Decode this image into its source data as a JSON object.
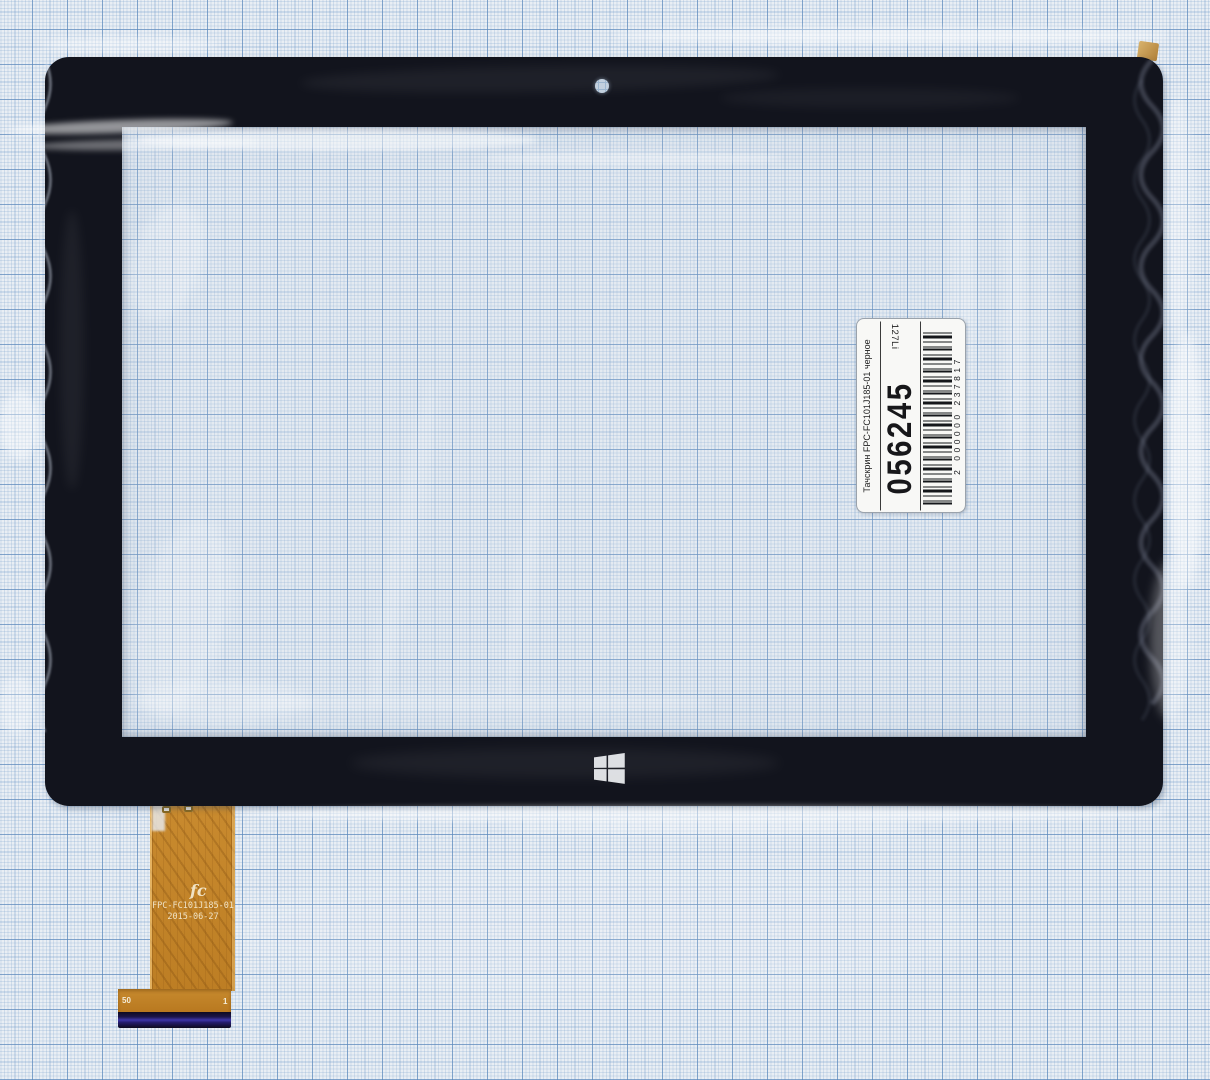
{
  "label": {
    "title": "Тачскрин FPC-FC101J185-01 черное",
    "number": "056245",
    "side_code": "127Li",
    "barcode_digits": "2 000000 237817",
    "barcode_icon": "barcode-icon"
  },
  "cable": {
    "logo_text": "fc",
    "model": "FPC-FC101J185-01",
    "date": "2015-06-27",
    "pin_first": "50",
    "pin_last": "1"
  },
  "frame": {
    "windows_logo_icon": "windows-logo-icon",
    "camera_hole_icon": "camera-hole-icon"
  },
  "colors": {
    "paper": "#e9eef4",
    "grid_major": "#6f9cc8",
    "grid_minor": "#aec6de",
    "frame_black": "#12141d",
    "cable_copper": "#c28529",
    "connector_blue": "#3d35a8",
    "label_background": "#f8f8f6"
  }
}
